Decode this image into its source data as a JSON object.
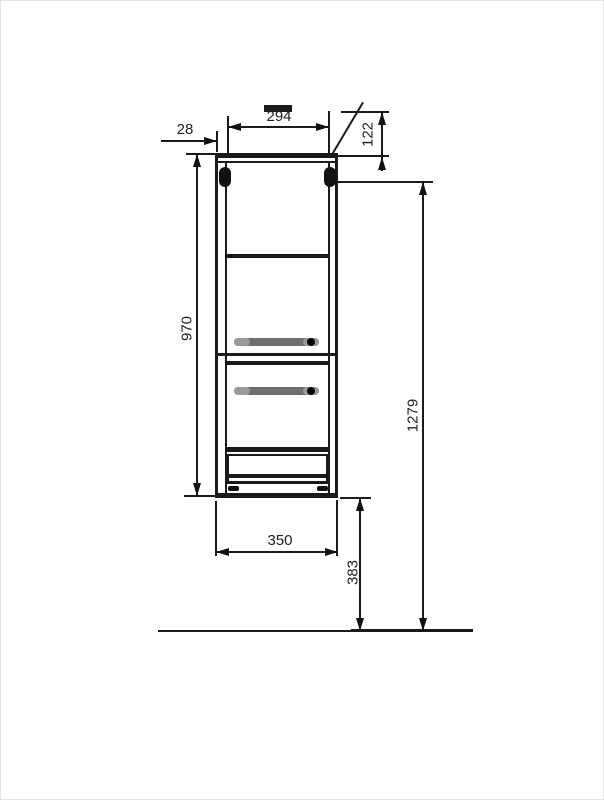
{
  "drawing": {
    "type": "technical-dimension-drawing",
    "subject": "wall-hung-cabinet-front-elevation",
    "dimensions": {
      "inner_width": "294",
      "side_panel_thickness": "28",
      "top_bracket_offset": "122",
      "cabinet_height": "970",
      "mounting_height": "1279",
      "overall_width": "350",
      "floor_clearance": "383"
    },
    "colors": {
      "line": "#1a1a1a",
      "handle": "#6e6e6e",
      "handle_cap": "#9a9a9a",
      "bracket": "#111111",
      "background": "#ffffff"
    }
  }
}
